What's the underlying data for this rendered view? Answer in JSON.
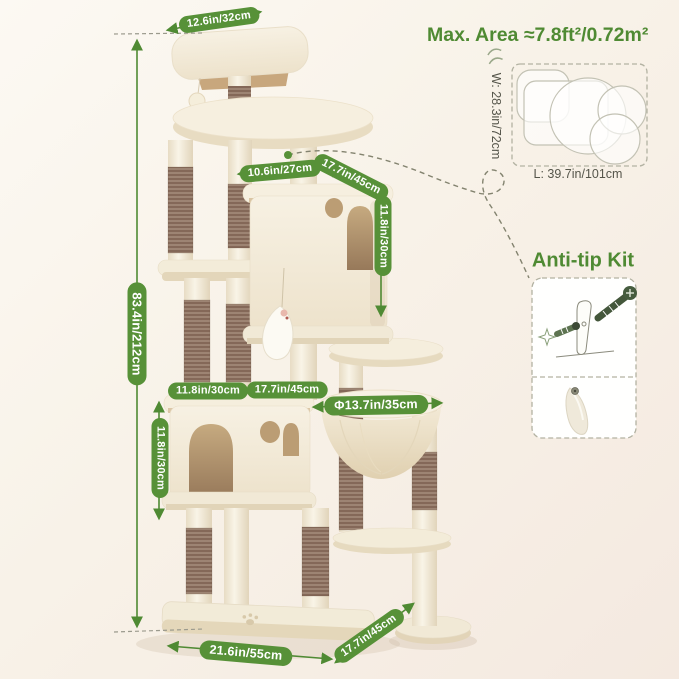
{
  "annotations": {
    "max_area": "Max. Area ≈7.8ft²/0.72m²",
    "anti_tip_title": "Anti-tip Kit",
    "footprint_width": "W: 28.3in/72cm",
    "footprint_length": "L: 39.7in/101cm"
  },
  "dimensions": {
    "top_perch_width": "12.6in/32cm",
    "total_height": "83.4in/212cm",
    "top_platform_depth": "10.6in/27cm",
    "top_platform_width": "17.7in/45cm",
    "top_condo_height": "11.8in/30cm",
    "lower_condo_width": "11.8in/30cm",
    "lower_condo_depth": "17.7in/45cm",
    "hammock_diameter": "Φ13.7in/35cm",
    "lower_condo_height": "11.8in/30cm",
    "base_width": "21.6in/55cm",
    "base_depth": "17.7in/45cm"
  },
  "colors": {
    "accent_green": "#4f8a33",
    "pill_green": "#579138",
    "pill_text": "#ffffff",
    "gray_label_text": "#55554a",
    "plush_cream": "#f2e9d6",
    "sisal_brown": "#8d7160",
    "board_tan": "#c8a77d",
    "background_top": "#fcf9f3",
    "background_bottom": "#f4e9e0"
  },
  "icons": {
    "sparkle_icon": "✦",
    "screw_icon": "screw",
    "anchor_icon": "wall-anchor",
    "paw_print_icon": "paw",
    "mouse_toy_icon": "hanging-mouse-toy"
  }
}
